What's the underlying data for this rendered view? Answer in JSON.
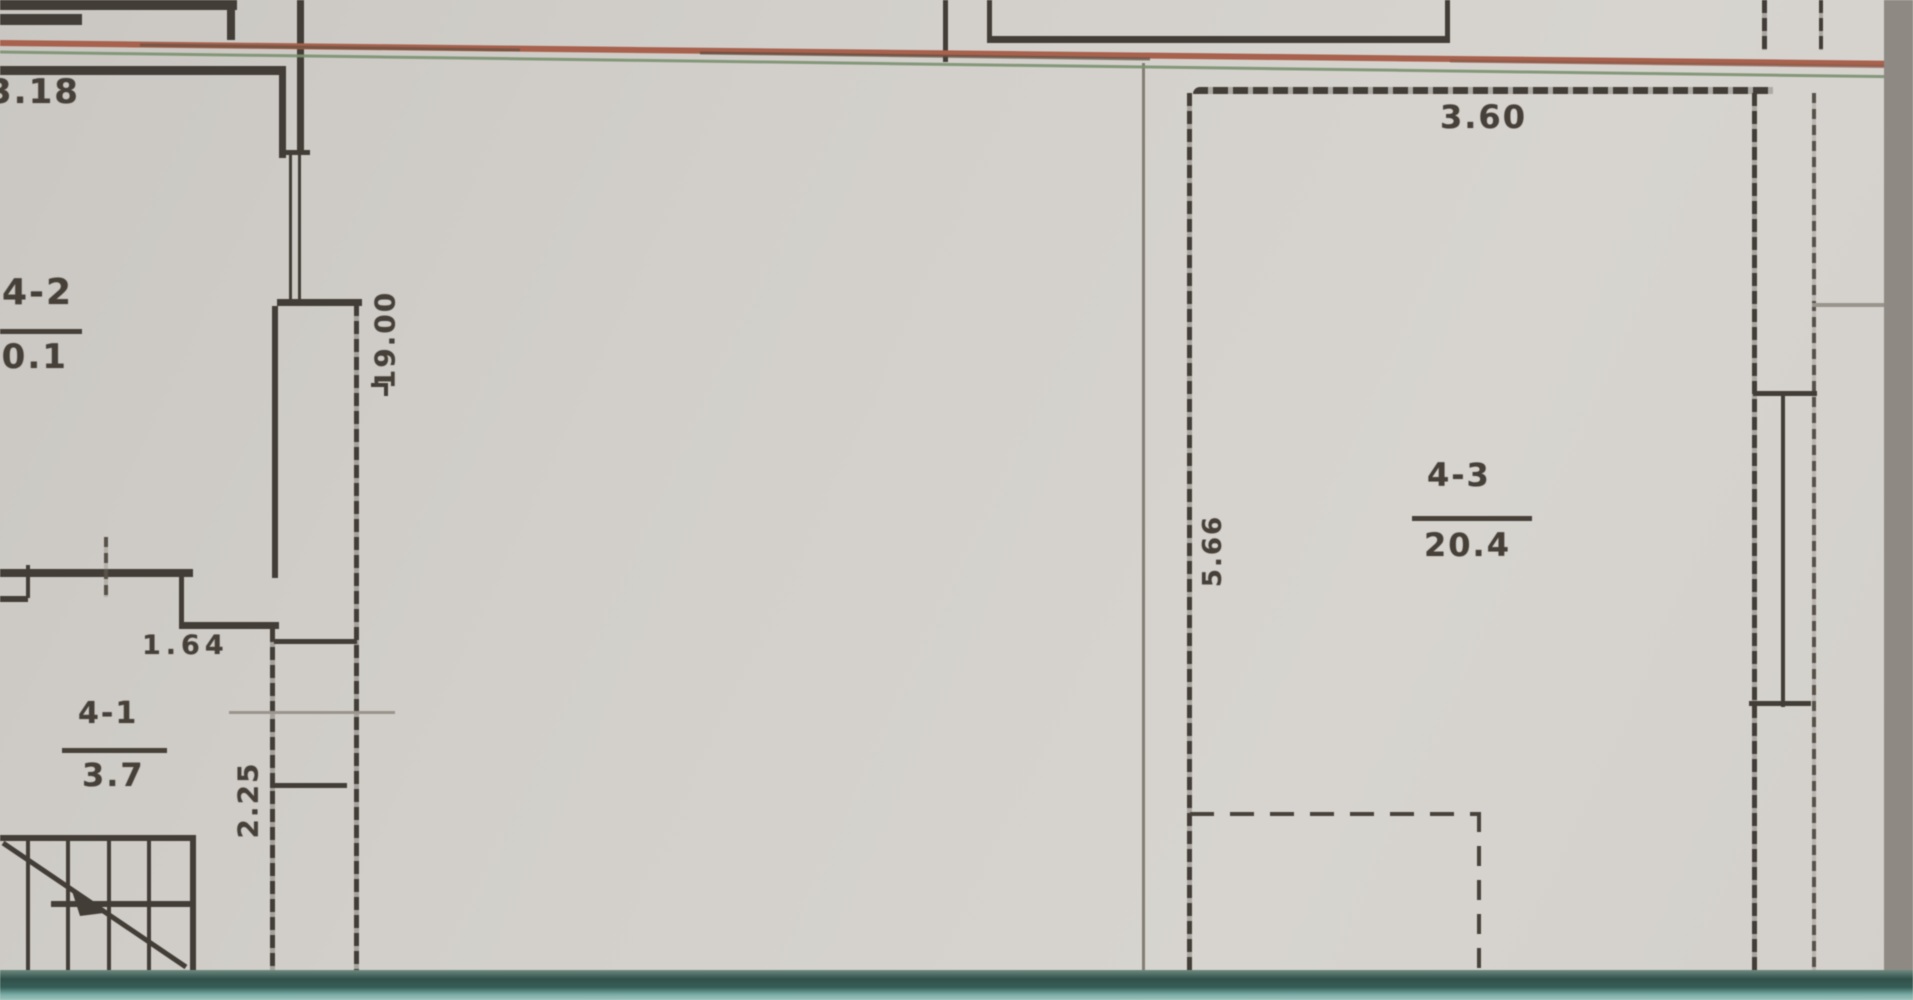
{
  "document": {
    "kind": "scanned-floor-plan",
    "colors": {
      "paper": "#d2cfca",
      "ink": "#423c36",
      "scan_red_line": "#a8604c",
      "scan_green_line": "#7c9270",
      "bottom_band_teal": "#2f4f49",
      "right_band_gray": "#8e8a83"
    }
  },
  "labels": {
    "dim_top_left": "3.18",
    "dim_height": "19.00",
    "dim_width_top": "3.60",
    "dim_room43_height": "5.66",
    "dim_164": "1.64",
    "dim_225": "2.25"
  },
  "rooms": {
    "r42": {
      "number": "4-2",
      "area": "20.1"
    },
    "r41": {
      "number": "4-1",
      "area": "3.7"
    },
    "r43": {
      "number": "4-3",
      "area": "20.4"
    }
  }
}
